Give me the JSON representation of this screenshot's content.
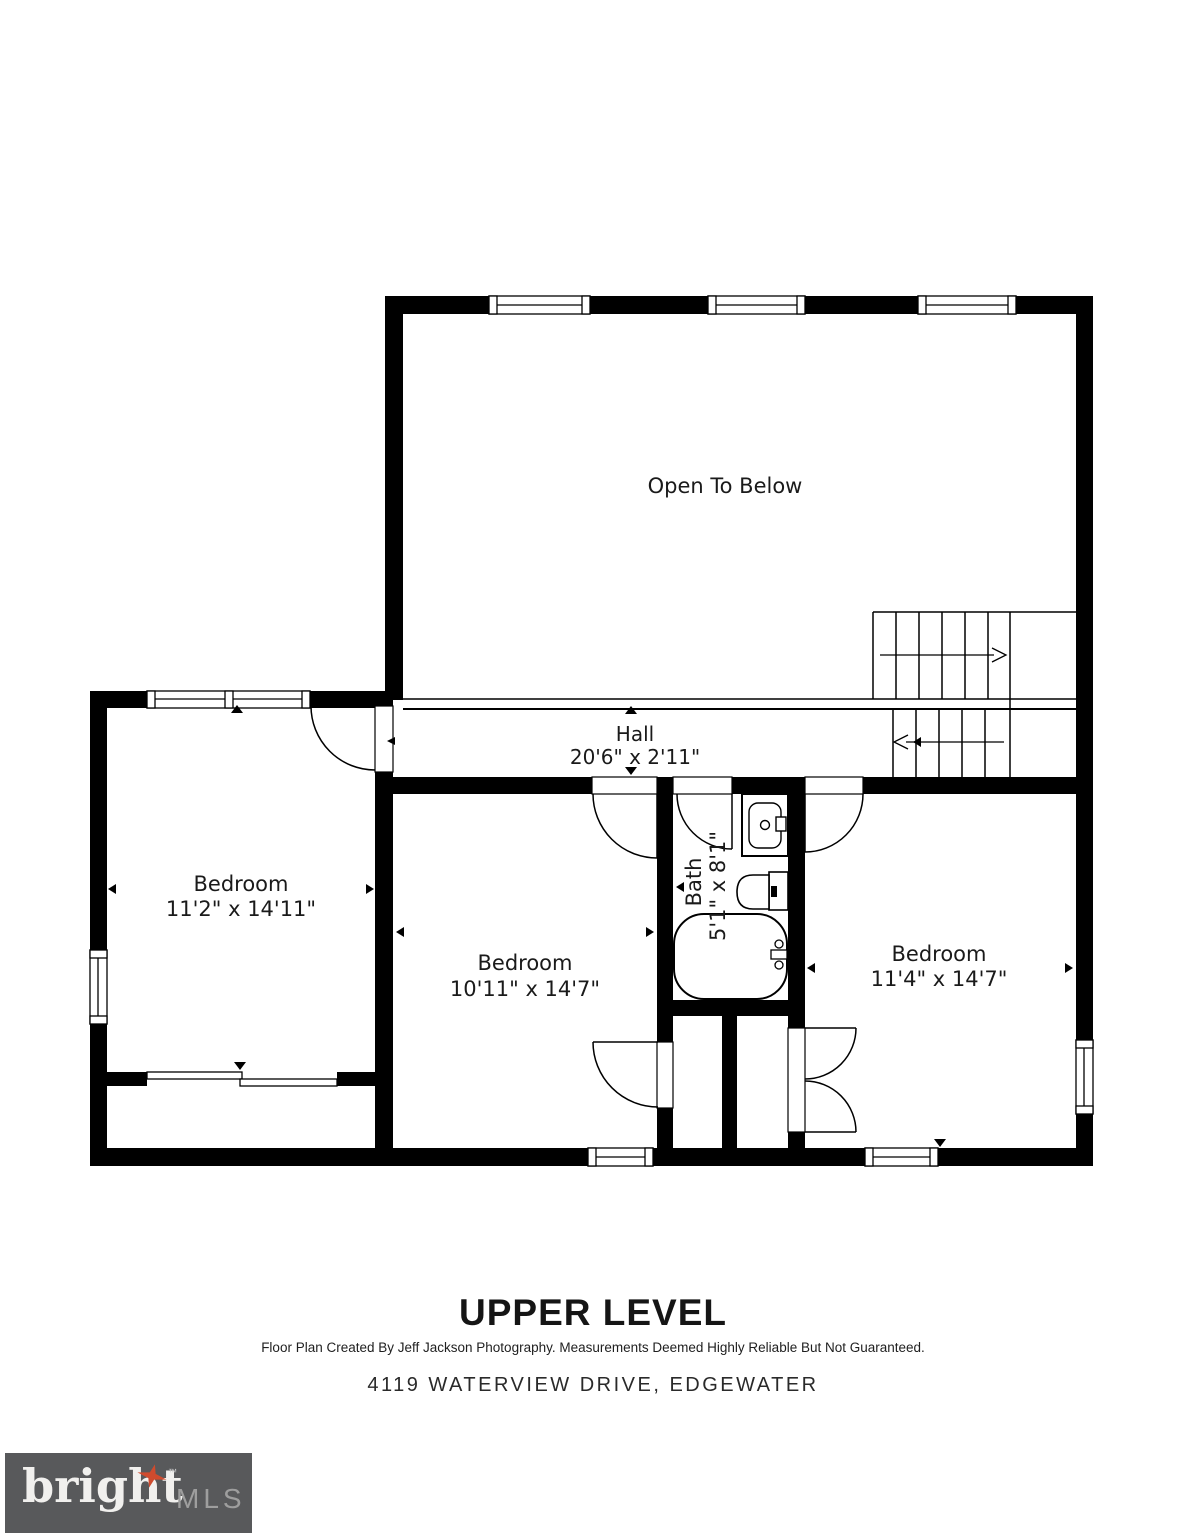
{
  "floor_plan": {
    "open_area": {
      "label": "Open To Below"
    },
    "hall": {
      "label": "Hall",
      "dimensions": "20'6\" x 2'11\""
    },
    "bedroom_left": {
      "label": "Bedroom",
      "dimensions": "11'2\" x 14'11\""
    },
    "bedroom_middle": {
      "label": "Bedroom",
      "dimensions": "10'11\" x 14'7\""
    },
    "bedroom_right": {
      "label": "Bedroom",
      "dimensions": "11'4\" x 14'7\""
    },
    "bath": {
      "label": "Bath",
      "dimensions": "5'1\" x 8'1\""
    }
  },
  "footer": {
    "level_title": "UPPER LEVEL",
    "disclaimer": "Floor Plan Created By Jeff Jackson Photography. Measurements Deemed Highly Reliable But Not Guaranteed.",
    "address": "4119 WATERVIEW DRIVE, EDGEWATER"
  },
  "logo": {
    "brand": "bright",
    "trademark": "™",
    "suffix": "MLS",
    "colors": {
      "background": "#58595b",
      "brand_text": "#f1f0ee",
      "suffix_text": "#9e9e9e",
      "star": "#cf4b2e"
    }
  },
  "plan_colors": {
    "walls": "#000000",
    "floor": "#ffffff"
  }
}
